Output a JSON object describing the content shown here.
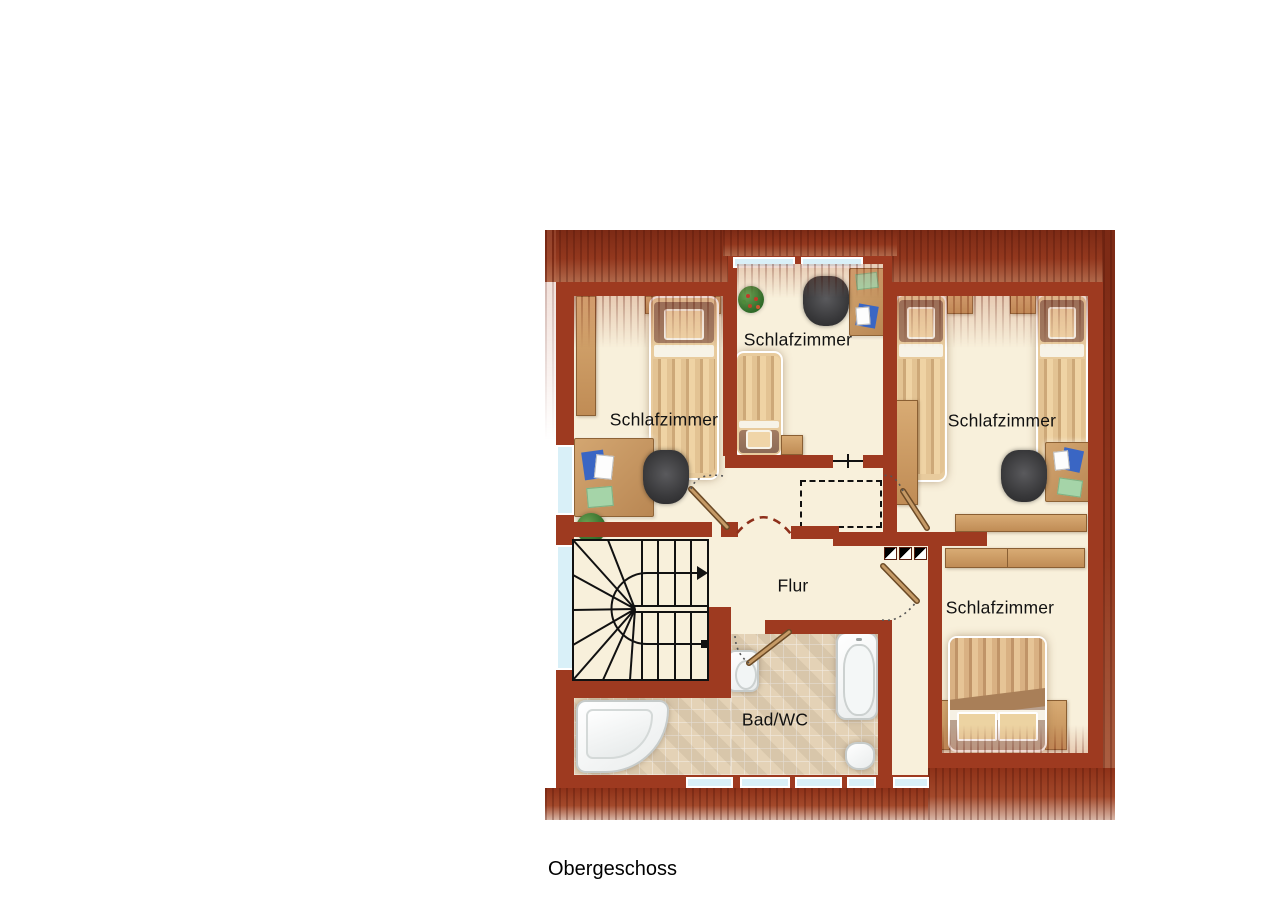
{
  "floor_label": "Obergeschoss",
  "plan": {
    "rooms": [
      {
        "name": "schlafzimmer-top-left",
        "label": "Schlafzimmer"
      },
      {
        "name": "schlafzimmer-top-middle",
        "label": "Schlafzimmer"
      },
      {
        "name": "schlafzimmer-top-right",
        "label": "Schlafzimmer"
      },
      {
        "name": "schlafzimmer-bottom-right",
        "label": "Schlafzimmer"
      },
      {
        "name": "flur",
        "label": "Flur"
      },
      {
        "name": "bad-wc",
        "label": "Bad/WC"
      }
    ],
    "furniture": [
      "single-bed",
      "double-bed",
      "desk",
      "office-chair",
      "wardrobe",
      "sideboard",
      "nightstand",
      "plant",
      "corner-bathtub",
      "bathtub",
      "sink",
      "toilet",
      "stairs",
      "door",
      "window"
    ],
    "colors": {
      "wall": "#9e3a20",
      "roof_dark": "#7c2a15",
      "floor": "#f8f0db",
      "tiles": "#eee1c8",
      "wood": "#c99a63",
      "window_glass": "#d9f0f8",
      "stair_lines": "#111111",
      "label_text": "#111111"
    }
  }
}
